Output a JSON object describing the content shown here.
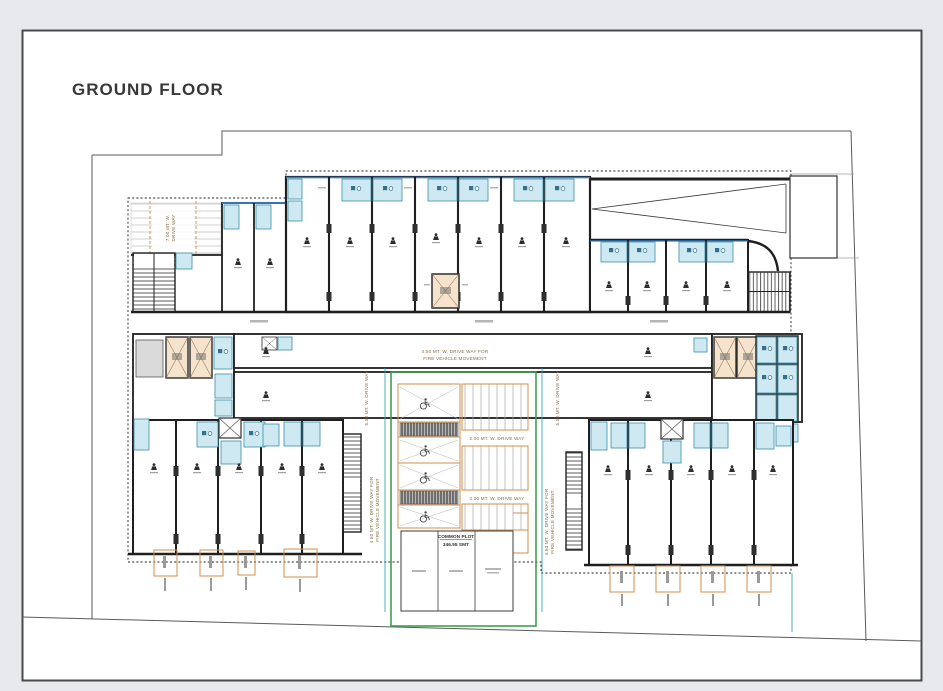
{
  "sheet": {
    "title": "GROUND FLOOR"
  },
  "labels": {
    "drive_way_7m_line1": "7.00 MT. W.",
    "drive_way_7m_line2": "DRIVE WAY",
    "drive_way_55m": "5.50 MT. W. DRIVE WAY",
    "drive_way_2m": "2.00 MT. W. DRIVE WAY",
    "fire_lane_line1": "4.50 MT. W. DRIVE WAY FOR",
    "fire_lane_line2": "FIRE VEHICLE MOVEMENT",
    "common_plot_name": "COMMON PLOT",
    "common_plot_area": "346.55 SMT"
  },
  "icons": {
    "shop_marker": "person-marker-icon",
    "accessible_parking": "wheelchair-icon",
    "lift": "lift-x-icon",
    "duct": "duct-x-icon",
    "stairs": "stairs-hatch-icon"
  },
  "colors": {
    "paper": "#ffffff",
    "canvas_bg": "#e7e9ec",
    "wall": "#1f1f1f",
    "toilet_fill": "#cfe9f2",
    "toilet_stroke": "#3d8fa8",
    "lift_fill": "#f5e3cc",
    "common_plot_green": "#3f9e53",
    "accent_orange": "#cf8f4e",
    "water_line_blue": "#2b82d9",
    "drain_teal": "#35a8b5"
  }
}
